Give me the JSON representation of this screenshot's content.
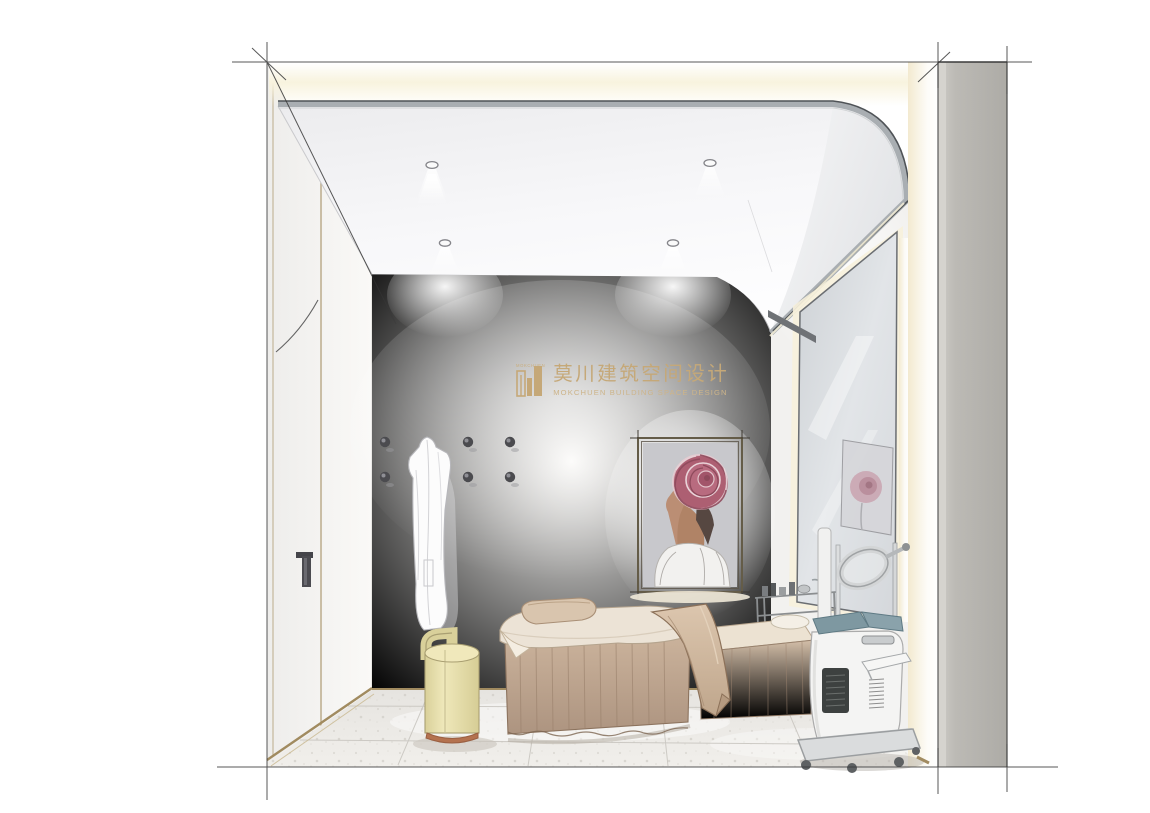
{
  "meta": {
    "kind": "interior-design-rendering",
    "subject": "spa facial treatment room, hand-drawn perspective rendering with sketch guide lines"
  },
  "watermark": {
    "icon": "mokchuen-buildings-logo",
    "icon_caption": "MOKCHUEN",
    "title_zh": "莫川建筑空间设计",
    "subtitle_en": "MOKCHUEN BUILDING SPACE DESIGN",
    "color": "#c5a878"
  },
  "scene": {
    "objects": [
      "flat white ceiling with four recessed downlights",
      "curved cove joining ceiling to mirror wall with gray trim rail",
      "warm cove light band along top opening",
      "left door panel with gold trim lines and black handle",
      "six round black wall hooks with hanging white bathrobe",
      "backlit framed artwork of woman with rose over her head",
      "tall leaning mirror reflecting the rose artwork",
      "stainless trolley with cosmetic bottles",
      "two beige skirted massage beds with rolled towel and draped runner",
      "cream cylindrical stool with copper base",
      "white facial machine with magnifying lamp on caster base",
      "terrazzo tile floor with perspective grout lines",
      "gray structural column on the right",
      "overshooting construction guide lines at corners"
    ]
  },
  "palette": {
    "background": "#ffffff",
    "ceiling_shade": "#ebecee",
    "wall": "#f4f3f1",
    "warm_glow": "#f8f3de",
    "trim_gold": "#a18b60",
    "rail_gray": "#a9aeb2",
    "rail_edge": "#4f5357",
    "floor": "#edebe7",
    "grout": "#c7c4be",
    "bed_skirt": "#c2aa94",
    "bed_sheet": "#ece2d4",
    "runner": "#cbb29a",
    "stool_body": "#e8e0ac",
    "stool_base": "#b4724f",
    "machine_body": "#f3f3f2",
    "machine_panel": "#3d4140",
    "machine_pad": "#7e98a1",
    "column": "#b1afaa",
    "artwork_canvas": "#c8c8cc",
    "rose": "#ad5f72",
    "skin": "#bb8e74",
    "hook": "#4b4b4f",
    "sketch_line": "#3a3a3a"
  }
}
